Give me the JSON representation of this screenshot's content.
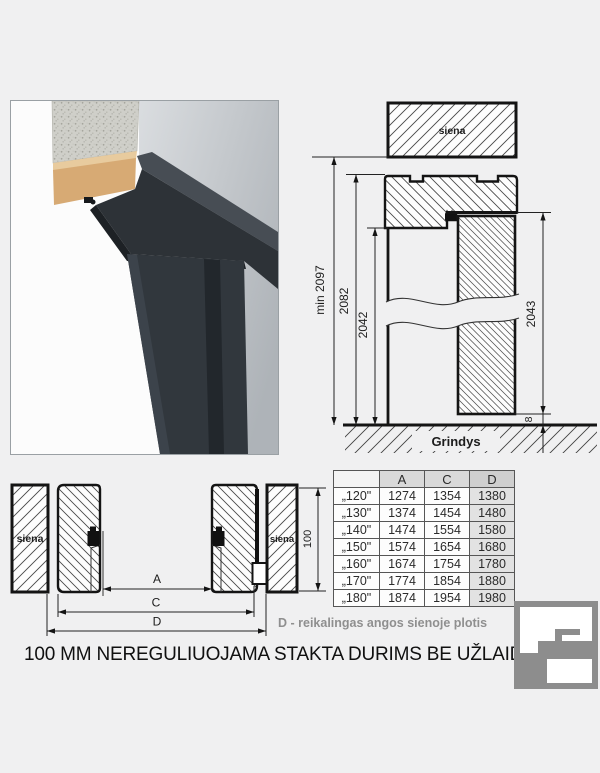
{
  "title": "100 MM NEREGULIUOJAMA STAKTA DURIMS BE UŽLAIDOS",
  "note": "D - reikalingas angos sienoje plotis",
  "colors": {
    "background": "#f0f0f1",
    "line": "#141414",
    "note_gray": "#8f8f8f",
    "logo_gray": "#8d8d8d",
    "frame_dark": "#2e3338",
    "wall_gray": "#c3c8cc",
    "concrete_gray": "#cfcfc9",
    "plaster_tan": "#d7aa74",
    "table_header_bg": "#d9d9d9",
    "table_d_col_bg": "#e2e2e2"
  },
  "vertical_section": {
    "wall_label": "siena",
    "floor_label": "Grindys",
    "dim_total": "min 2097",
    "dim_frame": "2082",
    "dim_opening": "2042",
    "dim_door": "2043",
    "dim_gap": "8"
  },
  "horizontal_section": {
    "wall_label_left": "siena",
    "wall_label_right": "siena",
    "dim_a": "A",
    "dim_c": "C",
    "dim_d": "D",
    "dim_depth": "100"
  },
  "table": {
    "headers": [
      "",
      "A",
      "C",
      "D"
    ],
    "rows": [
      {
        "size": "„120\"",
        "a": "1274",
        "c": "1354",
        "d": "1380"
      },
      {
        "size": "„130\"",
        "a": "1374",
        "c": "1454",
        "d": "1480"
      },
      {
        "size": "„140\"",
        "a": "1474",
        "c": "1554",
        "d": "1580"
      },
      {
        "size": "„150\"",
        "a": "1574",
        "c": "1654",
        "d": "1680"
      },
      {
        "size": "„160\"",
        "a": "1674",
        "c": "1754",
        "d": "1780"
      },
      {
        "size": "„170\"",
        "a": "1774",
        "c": "1854",
        "d": "1880"
      },
      {
        "size": "„180\"",
        "a": "1874",
        "c": "1954",
        "d": "1980"
      }
    ]
  }
}
